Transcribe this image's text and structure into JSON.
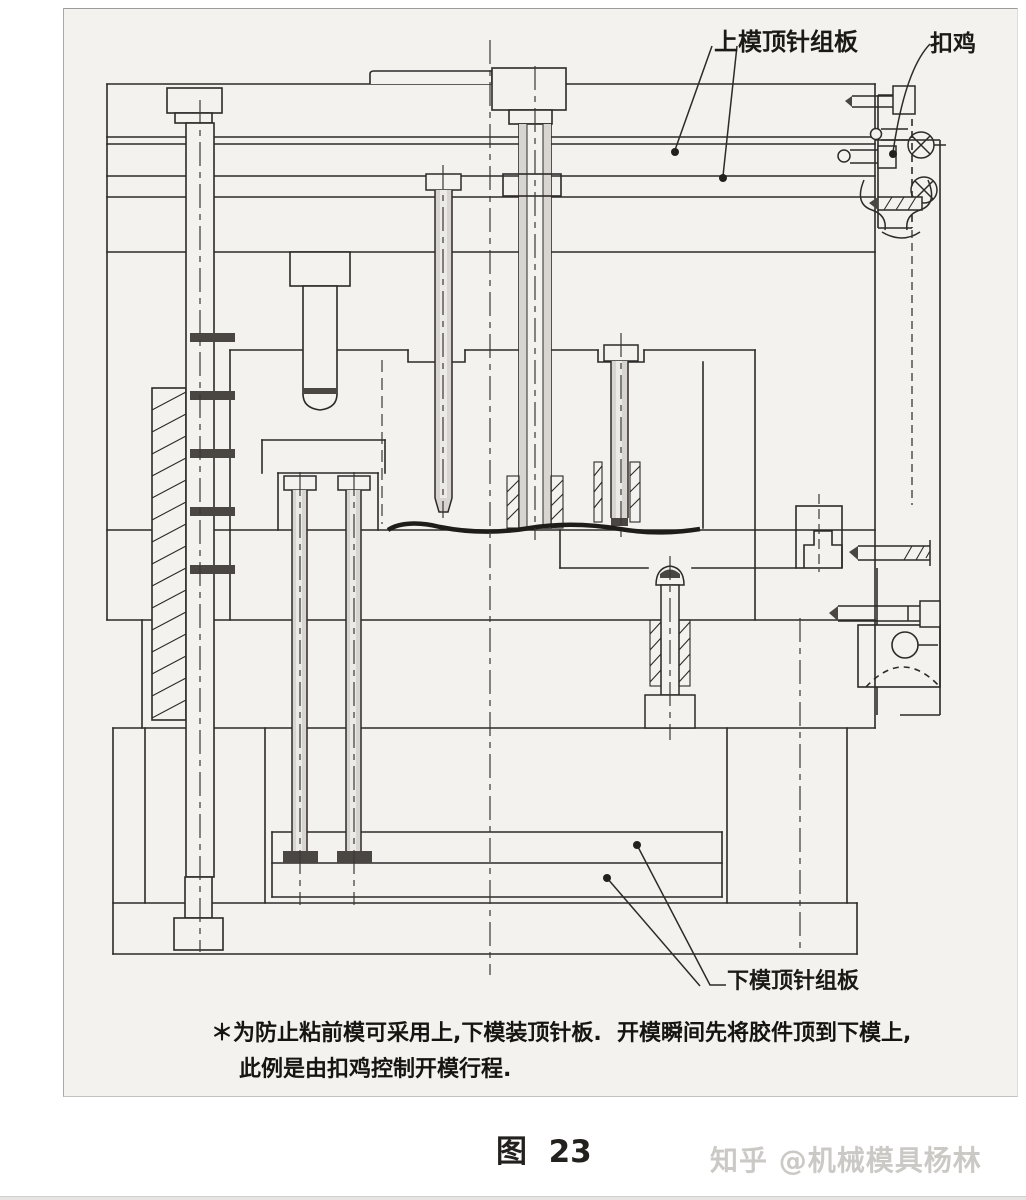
{
  "figure": {
    "annotations": {
      "upper_ejector_plate_label": "上模顶针组板",
      "latch_label": "扣鸡",
      "lower_ejector_plate_label": "下模顶针组板"
    },
    "footnote": {
      "line1": "＊为防止粘前模可采用上,下模装顶针板.  开模瞬间先将胶件顶到下模上,",
      "line2": "此例是由扣鸡控制开模行程."
    },
    "caption": "图  23",
    "watermark": "知乎 @机械模具杨林",
    "colors": {
      "page": "#ffffff",
      "paper": "#f3f2ef",
      "line": "#2d2b28",
      "dark_fill": "#4a4742",
      "pin_fill": "#d8d5d0",
      "watermark_text": "#cbc9c5"
    }
  }
}
